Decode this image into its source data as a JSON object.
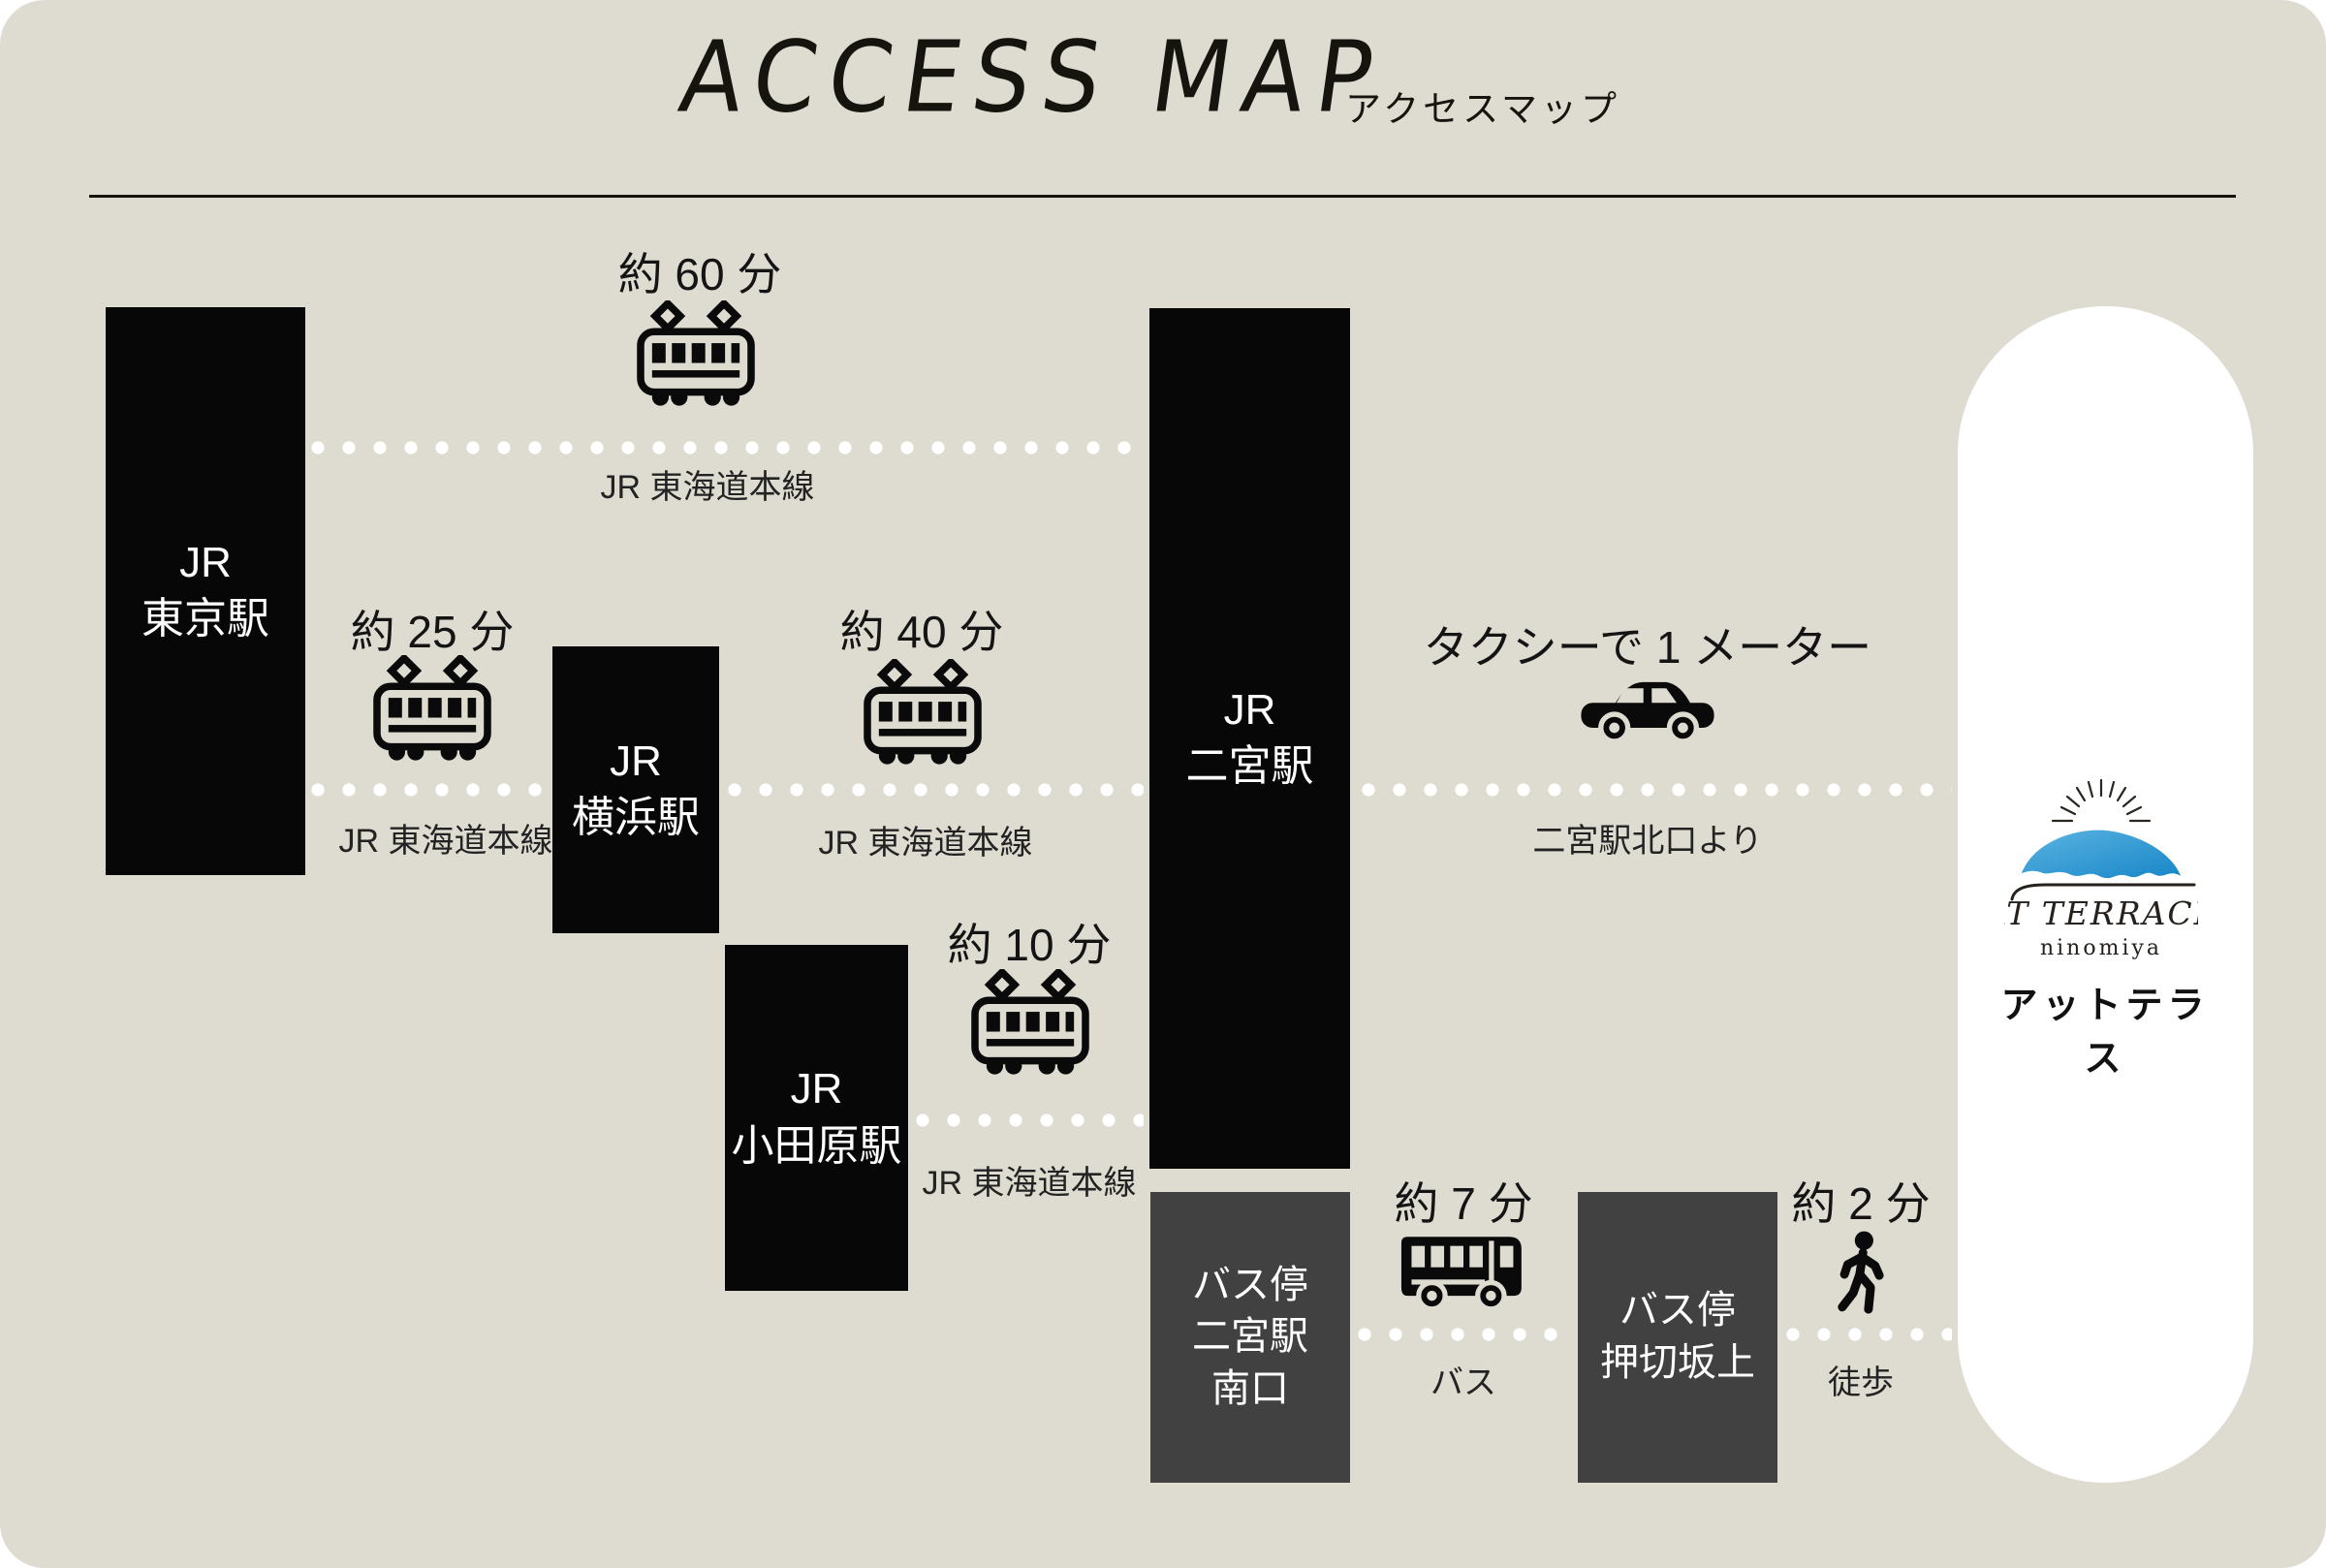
{
  "header": {
    "title": "ACCESS MAP",
    "subtitle": "アクセスマップ"
  },
  "stations": [
    {
      "id": "tokyo",
      "lines": [
        "JR",
        "東京駅"
      ]
    },
    {
      "id": "yokohama",
      "lines": [
        "JR",
        "横浜駅"
      ]
    },
    {
      "id": "odawara",
      "lines": [
        "JR",
        "小田原駅"
      ]
    },
    {
      "id": "ninomiya",
      "lines": [
        "JR",
        "二宮駅"
      ]
    }
  ],
  "bus_stops": [
    {
      "id": "ninomiya-south",
      "lines": [
        "バス停",
        "二宮駅",
        "南口"
      ]
    },
    {
      "id": "oshikirizakaue",
      "lines": [
        "バス停",
        "押切坂上"
      ]
    }
  ],
  "routes": [
    {
      "id": "tokyo-ninomiya",
      "mode": "train",
      "time": "約 60 分",
      "caption": "JR 東海道本線"
    },
    {
      "id": "tokyo-yokohama",
      "mode": "train",
      "time": "約 25 分",
      "caption": "JR 東海道本線"
    },
    {
      "id": "yokohama-ninomiya",
      "mode": "train",
      "time": "約 40 分",
      "caption": "JR 東海道本線"
    },
    {
      "id": "odawara-ninomiya",
      "mode": "train",
      "time": "約 10 分",
      "caption": "JR 東海道本線"
    },
    {
      "id": "ninomiya-taxi",
      "mode": "taxi",
      "time": "タクシーで 1 メーター",
      "caption": "二宮駅北口より"
    },
    {
      "id": "bus-leg",
      "mode": "bus",
      "time": "約 7 分",
      "caption": "バス"
    },
    {
      "id": "walk-leg",
      "mode": "walk",
      "time": "約 2 分",
      "caption": "徒歩"
    }
  ],
  "destination": {
    "name_en": "AT TERRACE",
    "name_sub": "ninomiya",
    "name_jp": "アットテラス"
  },
  "colors": {
    "background": "#dedbd1",
    "station_box": "#070707",
    "bus_stop_box": "#414141",
    "dot": "#ffffff",
    "panel": "#ffffff",
    "logo_blue_light": "#5cb4e1",
    "logo_blue_dark": "#1786c8",
    "ink": "#16140f"
  }
}
